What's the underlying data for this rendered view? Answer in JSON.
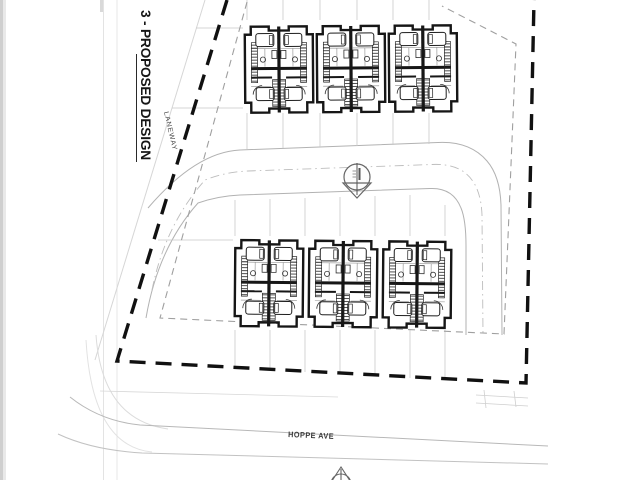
{
  "page": {
    "kind": "scanned site plan drawing",
    "background": "#ffffff"
  },
  "title": {
    "label": "3 - PROPOSED DESIGN"
  },
  "labels": {
    "laneway": "LANEWAY",
    "street": "HOPPE AVE"
  },
  "colors": {
    "ink": "#161616",
    "boundary": "#111111",
    "setback": "#9f9f9f",
    "road": "#b2b2b2",
    "faint": "#c9c9c9",
    "label_text": "#3a3a3a"
  },
  "icons": {
    "north_arrow": "circle with vertical needle and triangle",
    "north_arrow_count": 2
  },
  "site": {
    "building_rows": [
      {
        "name": "north row",
        "buildings": 3,
        "units_per_building": 2
      },
      {
        "name": "south row",
        "buildings": 3,
        "units_per_building": 2
      }
    ],
    "boundary_style": "heavy dashed line",
    "setback_style": "light dashed line",
    "road": "internal loop road with dash-dot centerline"
  }
}
